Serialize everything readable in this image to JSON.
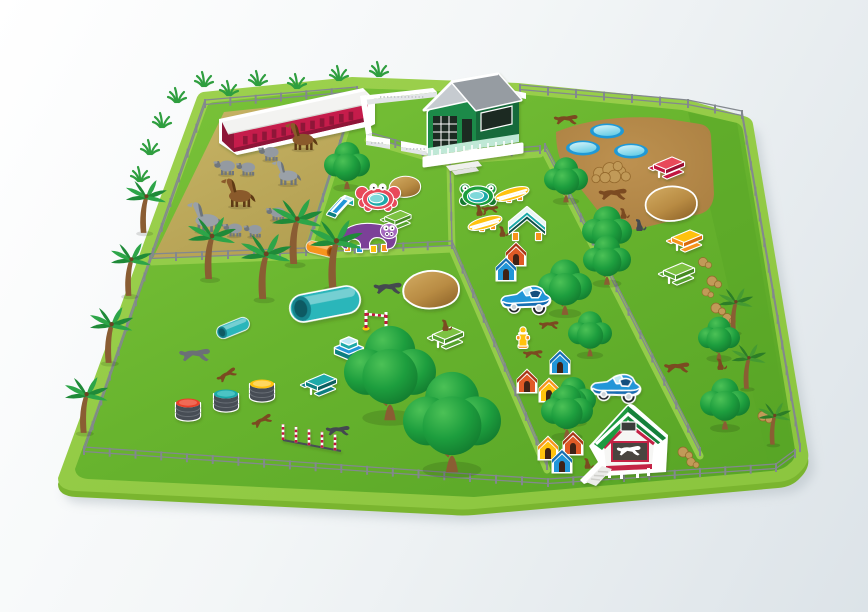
{
  "scene": {
    "subject": "Isometric cartoon map of a fenced farm and dog playground park",
    "style": "flat vector illustration with white sticker outlines on play equipment"
  },
  "palette": {
    "bg-from": "#ffffff",
    "bg-mid": "#f3f6f7",
    "bg-to": "#dce3e8",
    "rim": "#8cc63f",
    "rim-light": "#9ed24f",
    "rim-edge": "#7ab52f",
    "grass": "#68b42e",
    "grass-deep": "#58a526",
    "grass-bright": "#7cc43a",
    "aisle": "#93cc49",
    "paddock": "#c9b567",
    "paddock-dark": "#b3a052",
    "dirt": "#bd9150",
    "dirt-dark": "#aa7f41",
    "fence": "#83888e",
    "sticker": "#ffffff",
    "shadow": "#b9c2c8",
    "stable-red": "#c51c4c",
    "stable-red-dark": "#8e1237",
    "roof-white": "#f3f3f1",
    "roof-gray": "#969ca2",
    "roof-gray-light": "#c6cbd0",
    "house-green": "#1d8a4a",
    "house-green-dark": "#156b3a",
    "mint": "#bfe8d6",
    "window-dark": "#1c2a22",
    "barn-green": "#1b9a40",
    "barn-green-dark": "#12813a",
    "crimson": "#c42045",
    "wall-cream": "#f6f6f4",
    "ramp-gray": "#ebebe9",
    "tree-light": "#4cc156",
    "tree": "#1d9e3e",
    "tree-dark": "#127a2e",
    "trunk": "#8a5d33",
    "palm1": "#1f8a38",
    "palm2": "#2da548",
    "spalm1": "#2c7d27",
    "spalm2": "#459a31",
    "leaf": "#2f9e3f",
    "pool-ring": "#1f99d6",
    "water1": "#d8f4fa",
    "water2": "#6fd0e8",
    "rock1": "#d2ab62",
    "rock2": "#b88b43",
    "rock3": "#93682c",
    "rock-pile": "#c19a58",
    "sheep": "#949aa1",
    "sheep-dark": "#70767c",
    "horse-brown": "#8a5a2b",
    "horse-brown-dark": "#5e3a15",
    "horse-gray": "#9aa1a8",
    "horse-gray-dark": "#6d747b",
    "dog-brown": "#7b4a21",
    "dog-gray": "#6b7076",
    "dog-dark": "#44494f",
    "red": "#e8485a",
    "red-dark": "#c2183f",
    "yellow": "#ffc20e",
    "yellow-dark": "#f7941d",
    "orange": "#f7941d",
    "orange-dark": "#d96c10",
    "teal": "#1ca9a9",
    "teal-dark": "#0e7f80",
    "teal-deep": "#0d4f46",
    "blue": "#2196d8",
    "blue-dark": "#176eb2",
    "blue-light": "#bfe9f7",
    "green-table": "#7dc242",
    "green-table-dark": "#57a32e",
    "purple": "#7b3f98",
    "purple-dark": "#4a2361",
    "purple-light": "#a66bbf",
    "barrel": "#474d54",
    "barrel-light": "#6a7077"
  },
  "areas": [
    {
      "id": "horse-paddock",
      "label": "Horse and sheep paddock",
      "ground": "sand",
      "buildings": [
        "long red stable with white roof and row of dark doors"
      ],
      "animals": {
        "brown_horses": 2,
        "grey_horses": 2,
        "grey_sheep": 6
      }
    },
    {
      "id": "farmhouse-yard",
      "label": "Farmhouse courtyard",
      "walls": "low white walls with gates",
      "buildings": [
        "green farmhouse with grey gable roof, dark windows and white porch"
      ]
    },
    {
      "id": "dirt-dog-run",
      "label": "Dirt dog run (top right)",
      "features": [
        "3 blue paddling pools",
        "stone pile",
        "boulder sticker",
        "red picnic table",
        "yellow picnic table",
        "green picnic table",
        "2 trees"
      ],
      "animals": {
        "brown_dogs": 4
      }
    },
    {
      "id": "toddler-play-pen",
      "label": "Play pen with crab pool",
      "features": [
        "red crab paddling pool",
        "purple hippo crawl tunnel",
        "blue slide",
        "orange crawl tube",
        "green picnic table",
        "boulder",
        "tree"
      ]
    },
    {
      "id": "agility-pen",
      "label": "Agility pen with frog pool",
      "features": [
        "green frog paddling pool",
        "2 yellow balance boards",
        "teal A-frame ramp"
      ],
      "animals": {
        "brown_dogs": 3
      }
    },
    {
      "id": "training-field",
      "label": "Large training field (left)",
      "features": [
        "4 palm trees",
        "large teal crawl tunnel",
        "small teal tunnel",
        "3 barrel platforms (red, teal, yellow lids)",
        "teal picnic table",
        "teal steps",
        "striped practice hurdle",
        "5 slalom poles",
        "green picnic table",
        "2 boulders",
        "2 large trees"
      ],
      "animals": {
        "grey_dogs": 2,
        "brown_dogs": 3,
        "dark_dog": 1
      }
    },
    {
      "id": "kennel-lane",
      "label": "Kennel lane (diagonal, right)",
      "features": [
        "8 dog houses (blue, red, orange, yellow)",
        "2 blue sports cars",
        "yellow fire hydrant",
        "6 trees"
      ],
      "buildings": [
        "dog barn with green roof, white walls, red trim and white ramp"
      ],
      "animals": {
        "brown_dogs": 4
      }
    },
    {
      "id": "rocky-trail",
      "label": "Rocky trail along right edge",
      "features": [
        "trail of brown stones",
        "3 small palm trees",
        "2 trees"
      ],
      "animals": {
        "brown_dogs": 2
      }
    },
    {
      "id": "park-border",
      "label": "Park border",
      "features": [
        "grey post-and-rail fence around the park",
        "4 palm trees on the left verge",
        "grass tufts along the top edge"
      ]
    }
  ]
}
